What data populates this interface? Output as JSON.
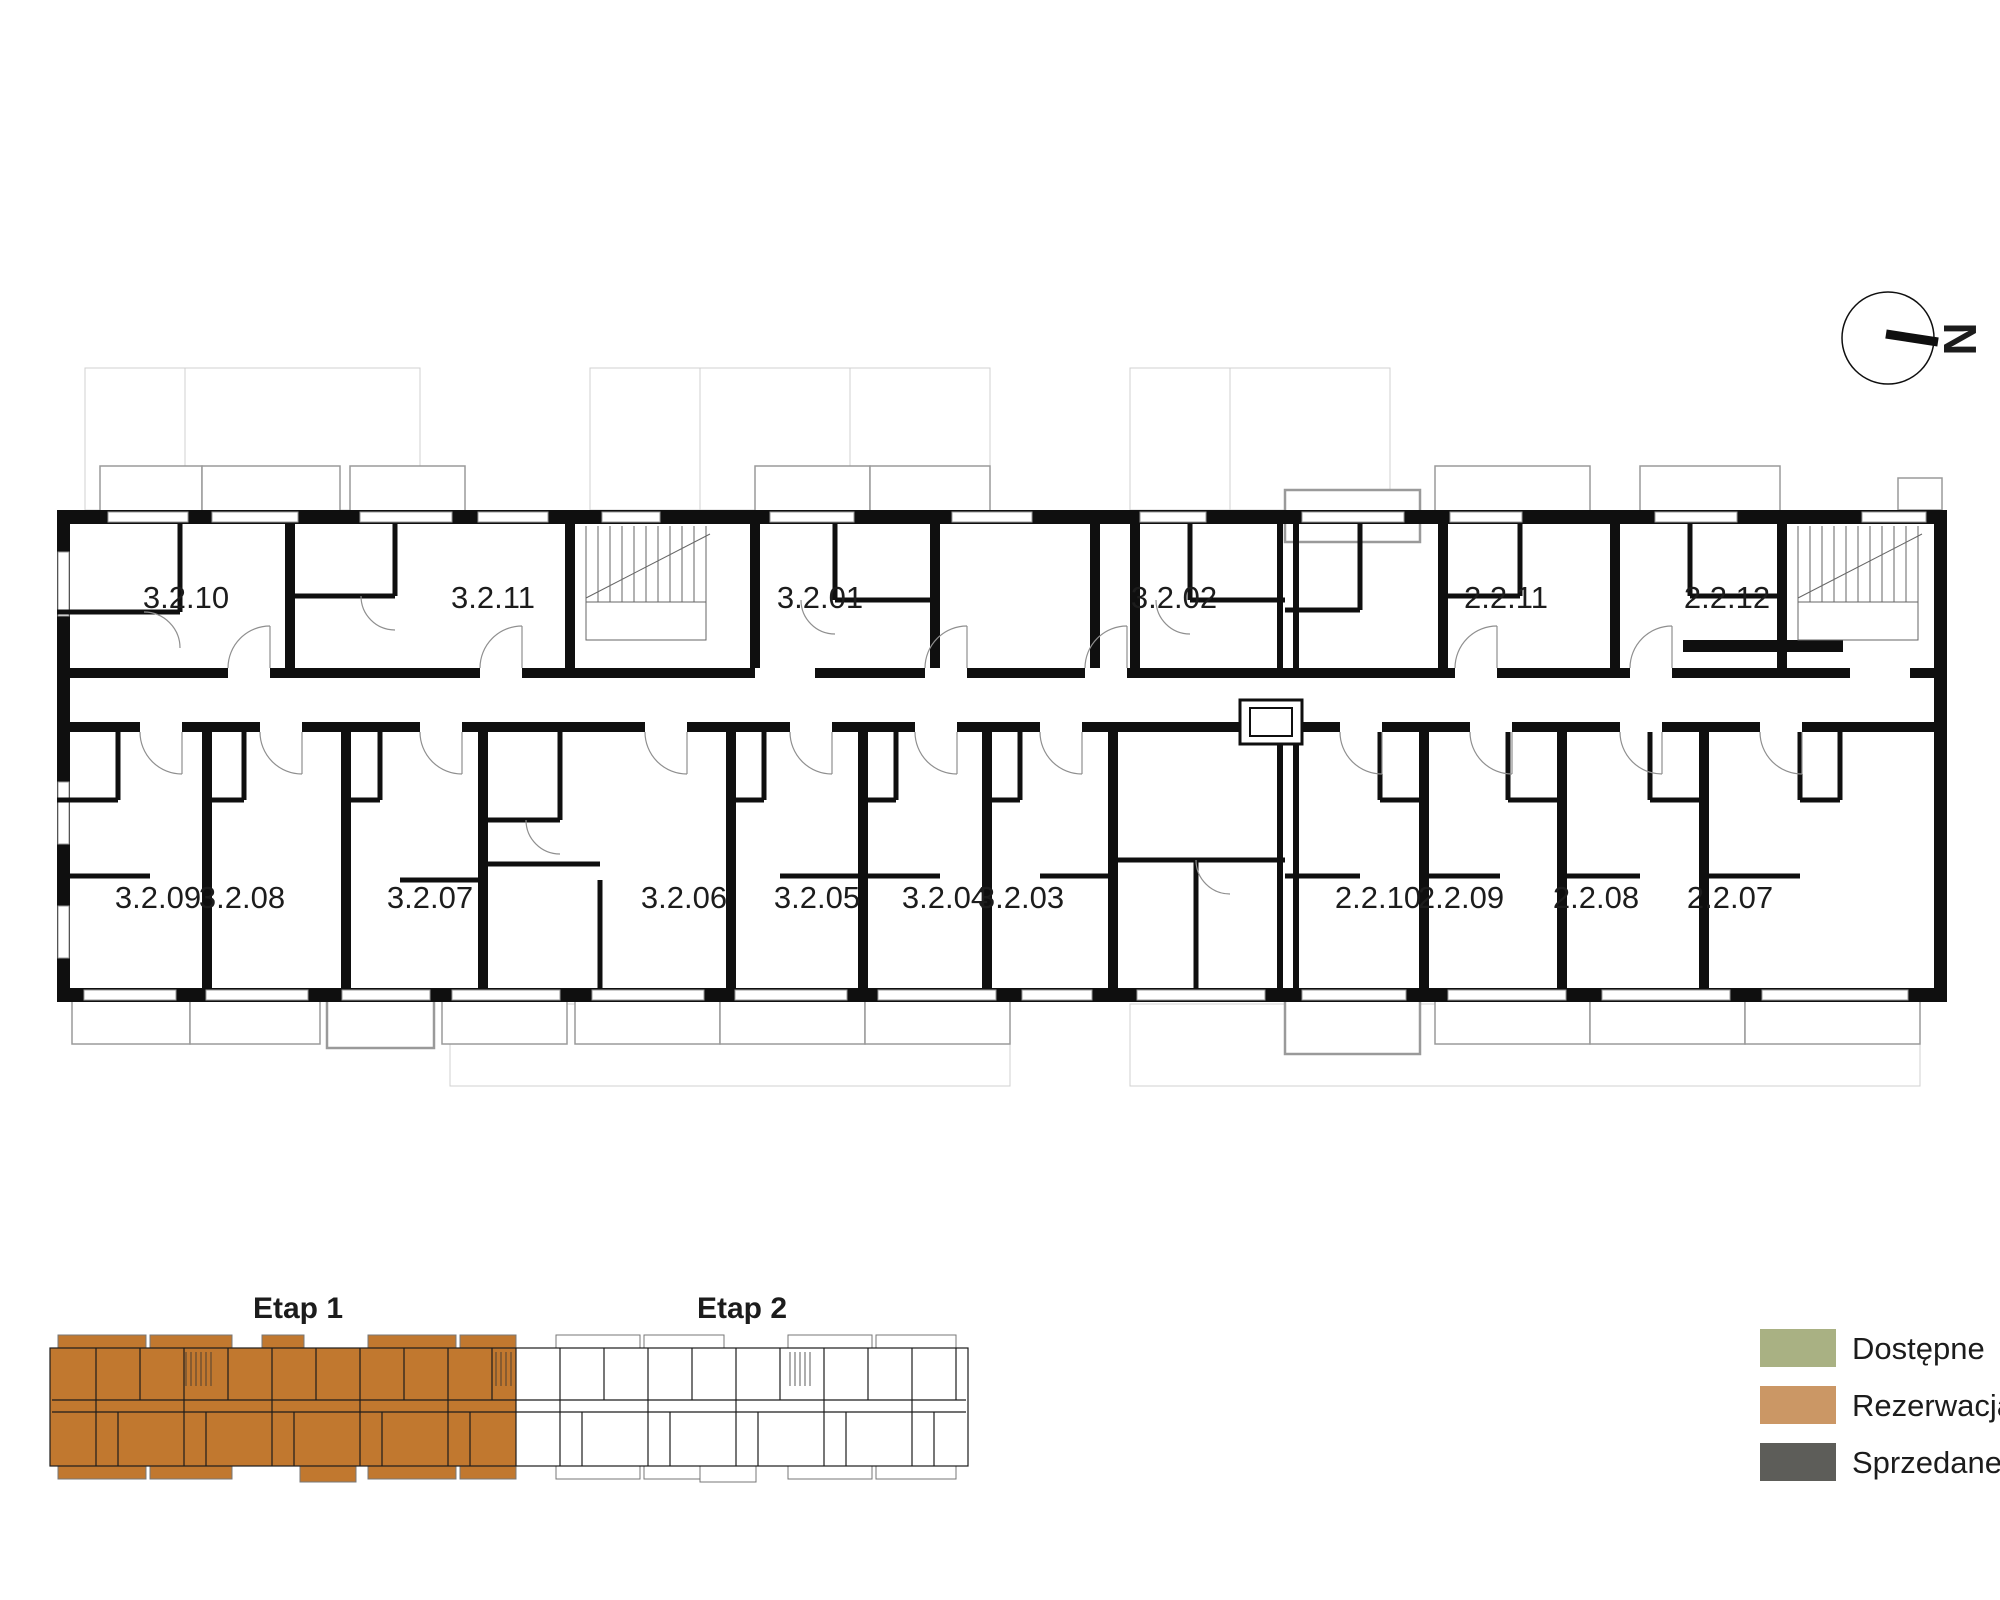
{
  "compass": {
    "north_label": "N"
  },
  "plan": {
    "top_units": [
      {
        "label": "3.2.10"
      },
      {
        "label": "3.2.11"
      },
      {
        "label": "3.2.01"
      },
      {
        "label": "3.2.02"
      },
      {
        "label": "2.2.11"
      },
      {
        "label": "2.2.12"
      }
    ],
    "bottom_units": [
      {
        "label": "3.2.09"
      },
      {
        "label": "3.2.08"
      },
      {
        "label": "3.2.07"
      },
      {
        "label": "3.2.06"
      },
      {
        "label": "3.2.05"
      },
      {
        "label": "3.2.04"
      },
      {
        "label": "3.2.03"
      },
      {
        "label": "2.2.10"
      },
      {
        "label": "2.2.09"
      },
      {
        "label": "2.2.08"
      },
      {
        "label": "2.2.07"
      }
    ]
  },
  "minimap": {
    "etap1_label": "Etap 1",
    "etap2_label": "Etap 2",
    "etap1_color": "#c1782f"
  },
  "legend": {
    "items": [
      {
        "label": "Dostępne",
        "color": "#a9b183"
      },
      {
        "label": "Rezerwacja",
        "color": "#cb9765"
      },
      {
        "label": "Sprzedane",
        "color": "#5d5d59"
      }
    ]
  }
}
